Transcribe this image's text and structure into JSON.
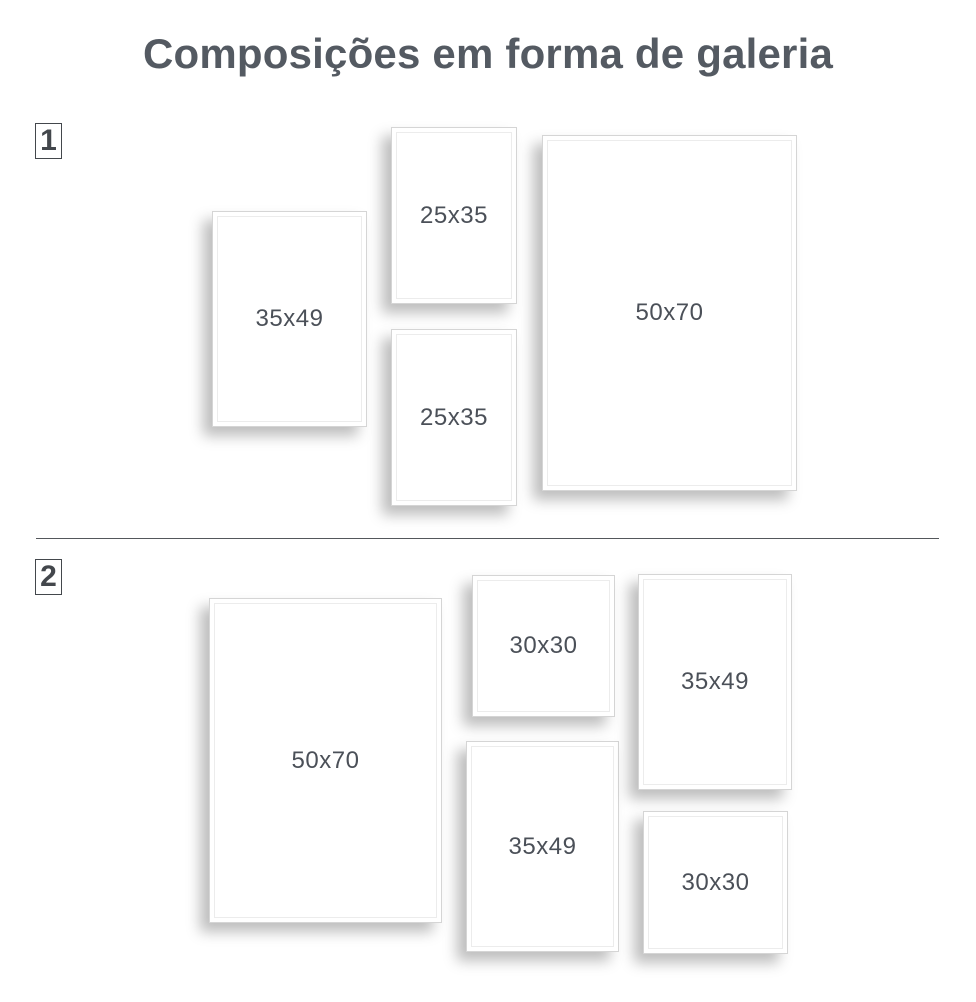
{
  "title": "Composições em forma de galeria",
  "sections": [
    {
      "number": "1",
      "frames": [
        {
          "label": "35x49"
        },
        {
          "label": "25x35"
        },
        {
          "label": "25x35"
        },
        {
          "label": "50x70"
        }
      ]
    },
    {
      "number": "2",
      "frames": [
        {
          "label": "50x70"
        },
        {
          "label": "30x30"
        },
        {
          "label": "35x49"
        },
        {
          "label": "35x49"
        },
        {
          "label": "30x30"
        }
      ]
    }
  ],
  "colors": {
    "background": "#ffffff",
    "title_text": "#545a62",
    "label_text": "#4b5058",
    "badge": "#43474c",
    "divider": "#54575b",
    "frame_border": "#d5d5d5",
    "frame_inner_line": "#ececec"
  }
}
